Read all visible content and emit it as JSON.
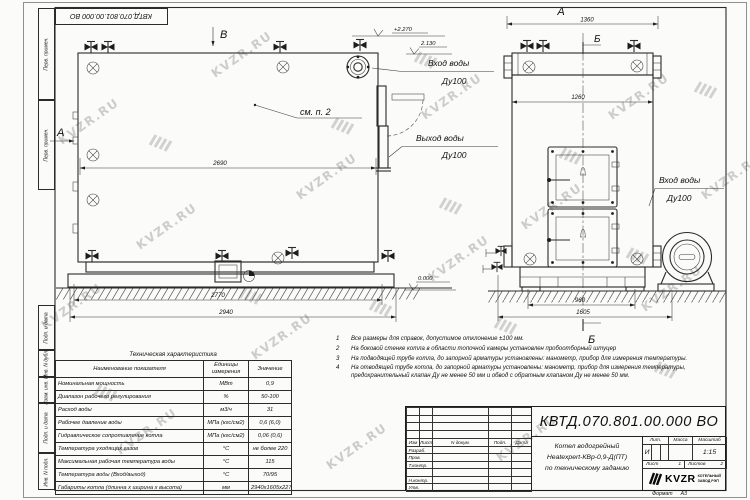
{
  "watermark": "KVZR.RU",
  "sheet": {
    "top_stamp": "КВТД.070.801.00.000 ВО",
    "side_stamps": [
      "Перв. примен.",
      "Перв. примен.",
      "Подп. и дата",
      "Инв. N дубл.",
      "Взам. инв. N",
      "Подп. и дата",
      "Инв. N подл."
    ]
  },
  "views": {
    "side": {
      "view_arrow_a": "А",
      "view_arrow_b": "В",
      "callout_note": "см. п. 2",
      "elev_top": "+2.270",
      "elev_inlet": "2.130",
      "elev_zero": "0.000",
      "inlet_label": "Вход воды",
      "inlet_dn": "Ду100",
      "outlet_label": "Выход воды",
      "outlet_dn": "Ду100",
      "dim_inner": "2690",
      "dim_frame": "2770",
      "dim_total": "2940"
    },
    "front": {
      "view_label": "А",
      "section_label": "Б",
      "dim_top": "1360",
      "dim_drum": "1260",
      "dim_base": "960",
      "dim_total": "1605",
      "inlet_label": "Вход воды",
      "inlet_dn": "Ду100"
    }
  },
  "notes": [
    {
      "num": "1",
      "text": "Все размеры для справок, допустимое отклонение ±100 мм."
    },
    {
      "num": "2",
      "text": "На боковой стенке котла в области топочной камеры установлен пробоотборный штуцер"
    },
    {
      "num": "3",
      "text": "На подводящей трубе котла, до запорной арматуры установлены: манометр, прибор для измерения температуры."
    },
    {
      "num": "4",
      "text": "На отводящей трубе котла, до запорной арматуры установлены: манометр, прибор для измерения температуры, предохранительный клапан Ду не менее 50 мм и обвод с обратным клапаном Ду не менее 50 мм."
    }
  ],
  "tech_table": {
    "title": "Техническая характеристика",
    "headers": [
      "Наименование показателя",
      "Единицы измерения",
      "Значение"
    ],
    "rows": [
      [
        "Номинальная мощность",
        "МВт",
        "0,9"
      ],
      [
        "Диапазон рабочего регулирования",
        "%",
        "50-100"
      ],
      [
        "Расход воды",
        "м3/ч",
        "31"
      ],
      [
        "Рабочее давление воды",
        "МПа (кгс/см2)",
        "0,6 (6,0)"
      ],
      [
        "Гидравлическое сопротивление котла",
        "МПа (кгс/см2)",
        "0,06 (0,6)"
      ],
      [
        "Температура уходящих газов",
        "°С",
        "не более 220"
      ],
      [
        "Максимальная рабочая температура воды",
        "°С",
        "115"
      ],
      [
        "Температура воды (Вход/выход)",
        "°С",
        "70/95"
      ],
      [
        "Габариты котла (длинна х ширина х высота)",
        "мм",
        "2940х1605х2270"
      ]
    ]
  },
  "title_block": {
    "doc_number": "КВТД.070.801.00.000 ВО",
    "description_line1": "Котел водогрейный",
    "description_line2": "Heatexpert-КВр-0,9-Д(ПТ)",
    "description_line3": "по техническому заданию",
    "rev_headers": [
      "Изм",
      "Лист",
      "N докум.",
      "Подп.",
      "Дата"
    ],
    "rev_rows": [
      "Разраб.",
      "Пров.",
      "Т.контр.",
      "",
      "Н.контр.",
      "Утв."
    ],
    "lit_label": "Лит.",
    "lit_value": "И",
    "mass_label": "Масса",
    "scale_label": "Масштаб",
    "scale_value": "1:15",
    "sheet_label": "Лист",
    "sheet_value": "1",
    "sheets_label": "Листов",
    "sheets_value": "2",
    "logo_text": "KVZR",
    "company_line1": "КОТЕЛЬНЫЙ",
    "company_line2": "ЗАВОД РЭП",
    "format_label": "Формат",
    "format_value": "А3"
  }
}
